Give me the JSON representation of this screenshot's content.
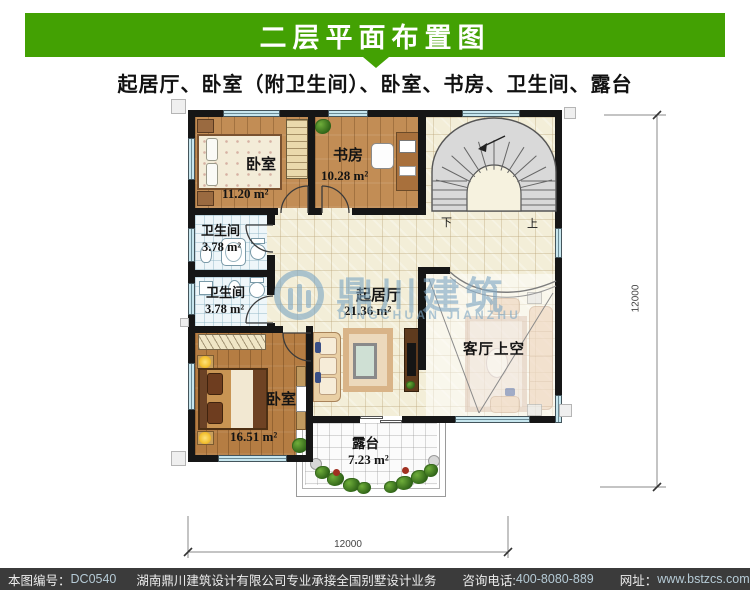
{
  "header": {
    "title": "二层平面布置图",
    "subtitle": "起居厅、卧室（附卫生间）、卧室、书房、卫生间、露台"
  },
  "colors": {
    "accent_green": "#43a103",
    "footer_bg": "#3b3b3b",
    "wall": "#161616",
    "window": "#c7e6ee"
  },
  "rooms": [
    {
      "name": "卧室",
      "area": "11.20 m²"
    },
    {
      "name": "书房",
      "area": "10.28 m²"
    },
    {
      "name": "卫生间",
      "area": "3.78 m²"
    },
    {
      "name": "卫生间",
      "area": "3.78 m²"
    },
    {
      "name": "起居厅",
      "area": "21.36 m²"
    },
    {
      "name": "卧室",
      "area": "16.51 m²"
    },
    {
      "name": "客厅上空",
      "area": ""
    },
    {
      "name": "露台",
      "area": "7.23 m²"
    }
  ],
  "stairs": {
    "down": "下",
    "up": "上"
  },
  "dimensions": {
    "bottom": "12000",
    "right": "12000"
  },
  "watermark": {
    "cn": "鼎川建筑",
    "en": "DINGCHUAN JIANZHU"
  },
  "footer": {
    "sheet_no_label": "本图编号：",
    "sheet_no": "DC0540",
    "company": "湖南鼎川建筑设计有限公司专业承接全国别墅设计业务",
    "phone_label": "咨询电话:",
    "phone": "400-8080-889",
    "web_label": "网址：",
    "web": "www.bstzcs.com"
  }
}
